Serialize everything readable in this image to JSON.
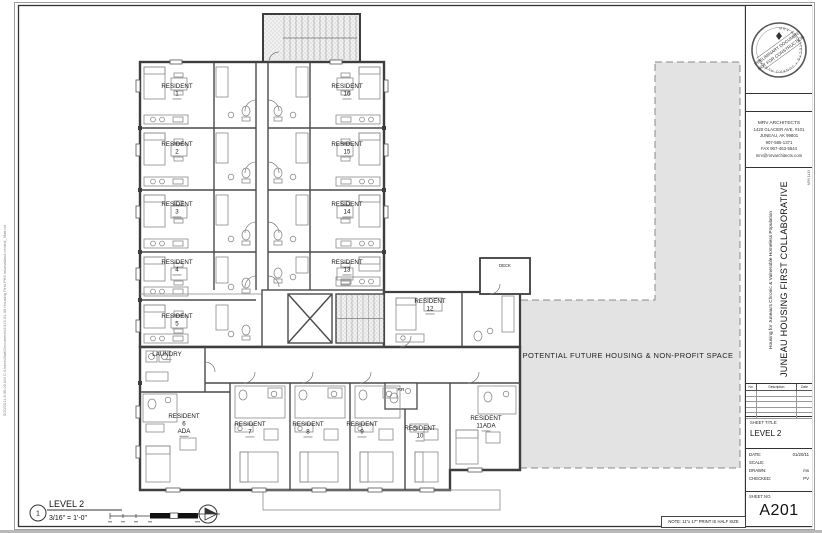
{
  "sheet": {
    "note": "NOTE: 11\"x 17\" PRINT IS HALF SIZE",
    "plot_stamp": "5/20/2011 8:36:09 AM    C:\\Users\\Matt\\Documents\\1413-01-08 Housing First PH3 mixmatland central_Matt.rvt"
  },
  "stamp": {
    "rim": "MRV ARCHITECTS • JUNEAU ALASKA",
    "line1": "PRELIMINARY DOCUMENT",
    "line2": "NOT FOR CONSTRUCTION"
  },
  "architect": {
    "lines": [
      "MRV ARCHITECTS",
      "1420 GLACIER AVE. #101",
      "JUNEAU, AK 99801",
      "907-586-1371",
      "FAX 907-463-5544",
      "mrv@mrvarchitects.com"
    ]
  },
  "project": {
    "subtitle": "Housing for Juneau's Chronic & Vulnerable Homeless Population",
    "title": "JUNEAU HOUSING FIRST COLLABORATIVE",
    "number": "MRV 1413"
  },
  "revisions": {
    "headers": [
      "No.",
      "Description",
      "Date"
    ]
  },
  "titleblock": {
    "sheet_title_label": "SHEET TITLE:",
    "sheet_title": "LEVEL 2",
    "date_label": "DATE:",
    "date": "01/20/11",
    "scale_label": "SCALE:",
    "scale": "",
    "drawn_label": "DRAWN:",
    "drawn": "ms",
    "checked_label": "CHECKED:",
    "checked": "PV",
    "sheet_no_label": "SHEET NO.",
    "sheet_no": "A201"
  },
  "view": {
    "number": "1",
    "title": "LEVEL 2",
    "scale": "3/16\" = 1'-0\""
  },
  "plan": {
    "future_space": "POTENTIAL FUTURE HOUSING & NON-PROFIT SPACE",
    "rooms": [
      {
        "id": "r1",
        "line1": "RESIDENT",
        "line2": "1"
      },
      {
        "id": "r2",
        "line1": "RESIDENT",
        "line2": "2"
      },
      {
        "id": "r3",
        "line1": "RESIDENT",
        "line2": "3"
      },
      {
        "id": "r4",
        "line1": "RESIDENT",
        "line2": "4"
      },
      {
        "id": "r5",
        "line1": "RESIDENT",
        "line2": "5"
      },
      {
        "id": "r16",
        "line1": "RESIDENT",
        "line2": "16"
      },
      {
        "id": "r15",
        "line1": "RESIDENT",
        "line2": "15"
      },
      {
        "id": "r14",
        "line1": "RESIDENT",
        "line2": "14"
      },
      {
        "id": "r13",
        "line1": "RESIDENT",
        "line2": "13"
      },
      {
        "id": "r12",
        "line1": "RESIDENT",
        "line2": "12"
      },
      {
        "id": "r6",
        "line1": "RESIDENT",
        "line2": "6",
        "line3": "ADA"
      },
      {
        "id": "r7",
        "line1": "RESIDENT",
        "line2": "7"
      },
      {
        "id": "r8",
        "line1": "RESIDENT",
        "line2": "8"
      },
      {
        "id": "r9",
        "line1": "RESIDENT",
        "line2": "9"
      },
      {
        "id": "r10",
        "line1": "RESIDENT",
        "line2": "10"
      },
      {
        "id": "r11",
        "line1": "RESIDENT",
        "line2": "11ADA"
      },
      {
        "id": "laundry",
        "line1": "LAUNDRY"
      },
      {
        "id": "rr",
        "line1": "RR"
      },
      {
        "id": "deck",
        "line1": "DECK"
      }
    ]
  }
}
